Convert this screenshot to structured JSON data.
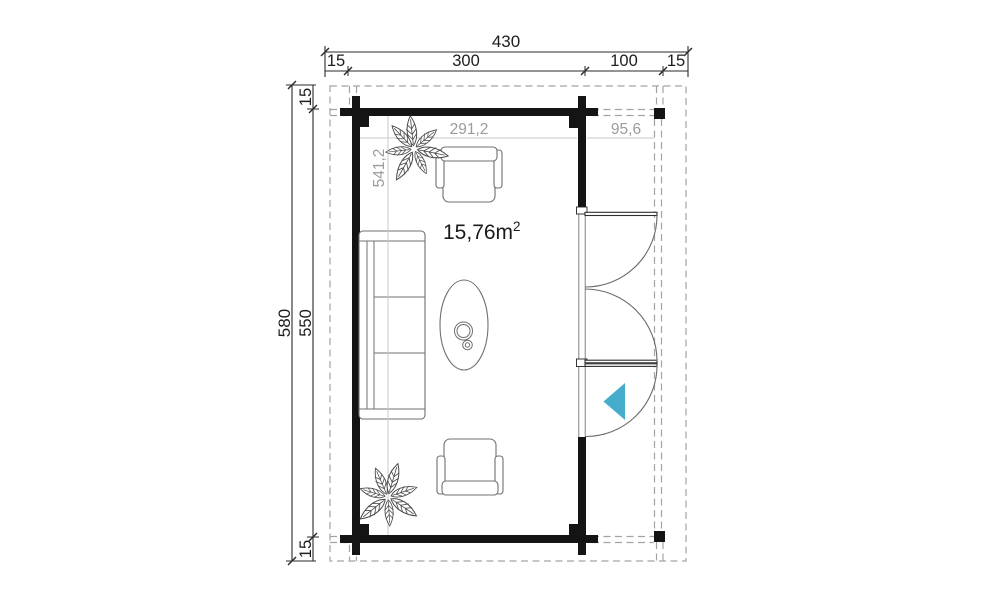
{
  "drawing": {
    "type": "log-cabin floor plan, top view, with covered porch on right side"
  },
  "colors": {
    "wall": "#141414",
    "arrow": "#45adcb",
    "dim_text": "#1d1d1d",
    "dim_gray_text": "#9b9b9b",
    "furniture_line": "#707070",
    "dash_line": "#a3a3a3"
  },
  "dimensions": {
    "top": {
      "total": "430",
      "segments": [
        "15",
        "300",
        "100",
        "15"
      ]
    },
    "left": {
      "total": "580",
      "inner": "550",
      "top_overhang": "15",
      "bottom_overhang": "15"
    },
    "interior": {
      "room_width": "291,2",
      "porch_width": "95,6",
      "room_depth": "541,2"
    }
  },
  "area": {
    "value": "15,76m",
    "sup": "2"
  }
}
